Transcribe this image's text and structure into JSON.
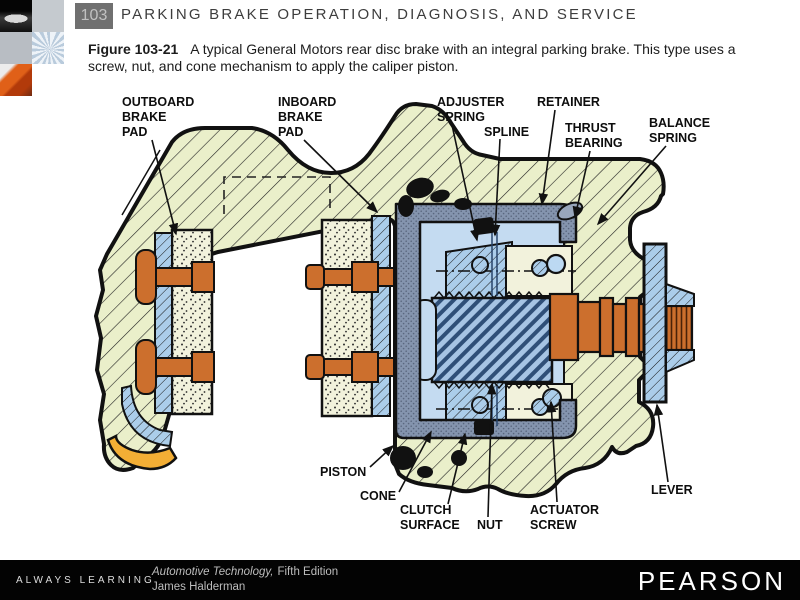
{
  "header": {
    "page_number": "103",
    "title": "PARKING BRAKE OPERATION, DIAGNOSIS, AND SERVICE"
  },
  "caption": {
    "figure_label": "Figure 103-21",
    "body": "A typical General Motors rear disc brake with an integral parking brake. This type uses a screw, nut, and cone mechanism to apply the caliper piston."
  },
  "sidebar": {
    "thumbnails": [
      "classic-car-photo",
      "gray-tile",
      "gray-tile",
      "wheel-pattern-photo",
      "orange-car-photo",
      "white-tile"
    ]
  },
  "diagram": {
    "labels": {
      "outboard": [
        "OUTBOARD",
        "BRAKE",
        "PAD"
      ],
      "inboard": [
        "INBOARD",
        "BRAKE",
        "PAD"
      ],
      "adjuster": [
        "ADJUSTER",
        "SPRING"
      ],
      "spline": [
        "SPLINE"
      ],
      "retainer": [
        "RETAINER"
      ],
      "thrust": [
        "THRUST",
        "BEARING"
      ],
      "balance": [
        "BALANCE",
        "SPRING"
      ],
      "piston": [
        "PISTON"
      ],
      "cone": [
        "CONE"
      ],
      "clutch": [
        "CLUTCH",
        "SURFACE"
      ],
      "nut": [
        "NUT"
      ],
      "actuator": [
        "ACTUATOR",
        "SCREW"
      ],
      "lever": [
        "LEVER"
      ]
    },
    "colors": {
      "caliper_body": "#eaefca",
      "pad_friction": "#f2f2dc",
      "blue_parts": "#abcdea",
      "piston_slate": "#8494ae",
      "interior_blue": "#c4dbf1",
      "orange_parts": "#cc6f2d",
      "wear_clip_yellow": "#f3ae35",
      "outline": "#111111"
    }
  },
  "footer": {
    "always_learning": "ALWAYS LEARNING",
    "series_italic": "Automotive Technology,",
    "series_rest": "Fifth Edition",
    "author": "James Halderman",
    "publisher": "PEARSON"
  }
}
